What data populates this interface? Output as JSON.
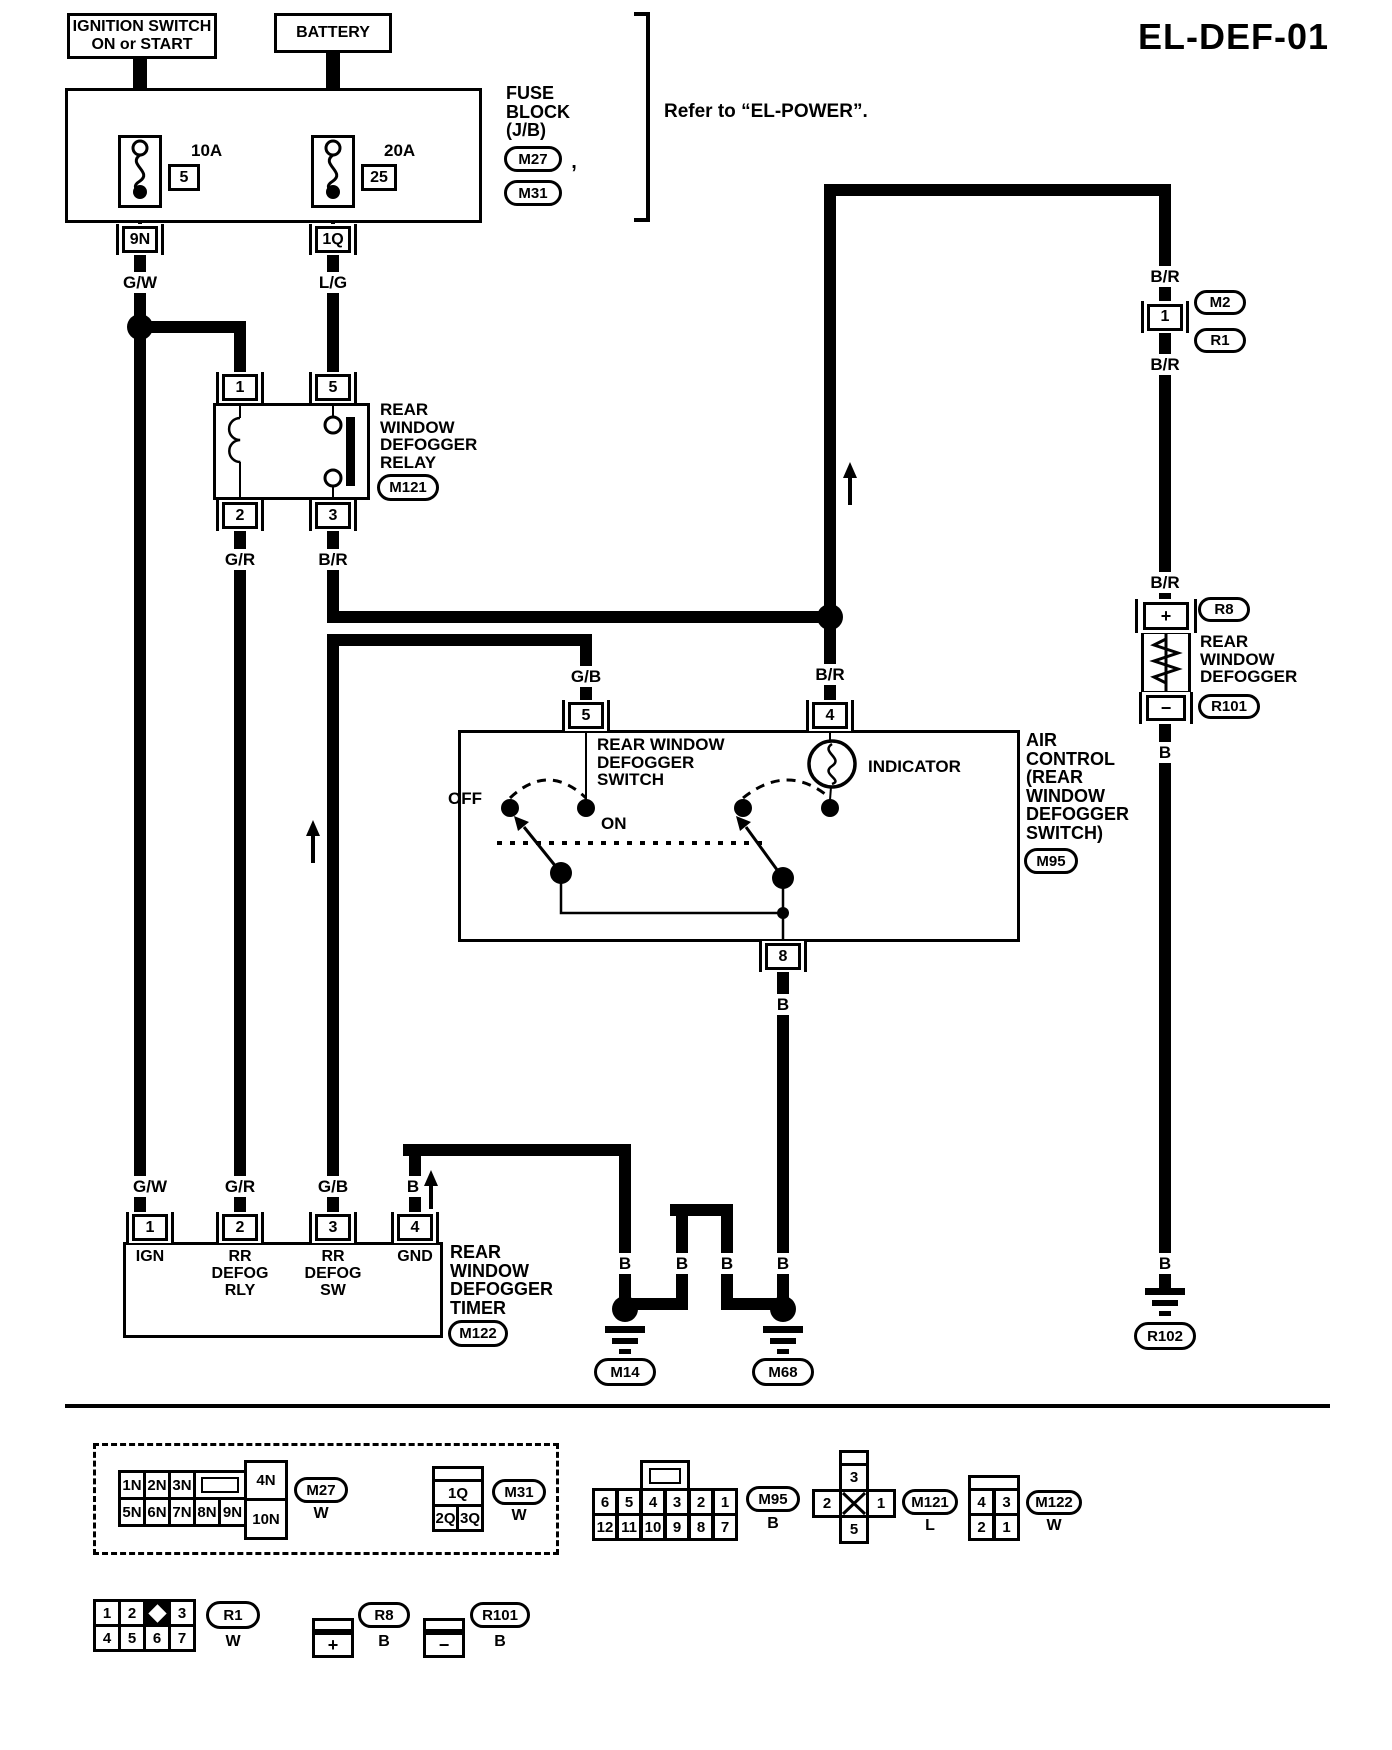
{
  "title": "EL-DEF-01",
  "refer_note": "Refer to “EL-POWER”.",
  "fuse_block": {
    "ignition_label": "IGNITION SWITCH\nON or START",
    "battery_label": "BATTERY",
    "block_label": "FUSE\nBLOCK\n(J/B)",
    "m27": "M27",
    "m31": "M31",
    "comma": ",",
    "fuse1": {
      "amp": "10A",
      "num": "5",
      "conn": "9N"
    },
    "fuse2": {
      "amp": "20A",
      "num": "25",
      "conn": "1Q"
    }
  },
  "wire_labels": {
    "gw": "G/W",
    "lg": "L/G",
    "gr": "G/R",
    "br": "B/R",
    "gb": "G/B",
    "b": "B"
  },
  "relay": {
    "pin1": "1",
    "pin5": "5",
    "pin2": "2",
    "pin3": "3",
    "name": "REAR\nWINDOW\nDEFOGGER\nRELAY",
    "id": "M121"
  },
  "body_conn": {
    "pin": "1",
    "m2": "M2",
    "r1": "R1"
  },
  "defogger": {
    "r8": "R8",
    "plus": "+",
    "name": "REAR\nWINDOW\nDEFOGGER",
    "minus": "−",
    "r101": "R101"
  },
  "switch": {
    "pin5": "5",
    "pin4": "4",
    "pin8": "8",
    "name": "REAR WINDOW\nDEFOGGER\nSWITCH",
    "off": "OFF",
    "on": "ON",
    "indicator": "INDICATOR",
    "air": "AIR\nCONTROL\n(REAR\nWINDOW\nDEFOGGER\nSWITCH)",
    "id": "M95"
  },
  "timer": {
    "pin1": "1",
    "pin2": "2",
    "pin3": "3",
    "pin4": "4",
    "lbl1": "IGN",
    "lbl2": "RR\nDEFOG\nRLY",
    "lbl3": "RR\nDEFOG\nSW",
    "lbl4": "GND",
    "name": "REAR\nWINDOW\nDEFOGGER\nTIMER",
    "id": "M122"
  },
  "grounds": {
    "m14": "M14",
    "m68": "M68",
    "r102": "R102"
  },
  "legend": {
    "m27": {
      "top": [
        "1N",
        "2N",
        "3N"
      ],
      "bottom": [
        "5N",
        "6N",
        "7N",
        "8N",
        "9N"
      ],
      "side_top": "4N",
      "side_bottom": "10N",
      "id": "M27",
      "color": "W"
    },
    "m31": {
      "top": "1Q",
      "bottom": [
        "2Q",
        "3Q"
      ],
      "id": "M31",
      "color": "W"
    },
    "m95": {
      "top": [
        "6",
        "5",
        "4",
        "3",
        "2",
        "1"
      ],
      "bottom": [
        "12",
        "11",
        "10",
        "9",
        "8",
        "7"
      ],
      "id": "M95",
      "color": "B"
    },
    "m121": {
      "top": "3",
      "left": "2",
      "right": "1",
      "bottom": "5",
      "id": "M121",
      "color": "L"
    },
    "m122": {
      "top": [
        "4",
        "3"
      ],
      "bottom": [
        "2",
        "1"
      ],
      "id": "M122",
      "color": "W"
    },
    "r1": {
      "top": [
        "1",
        "2",
        "3"
      ],
      "bottom": [
        "4",
        "5",
        "6",
        "7"
      ],
      "id": "R1",
      "color": "W"
    },
    "r8": {
      "sign": "+",
      "id": "R8",
      "color": "B"
    },
    "r101": {
      "sign": "−",
      "id": "R101",
      "color": "B"
    }
  }
}
